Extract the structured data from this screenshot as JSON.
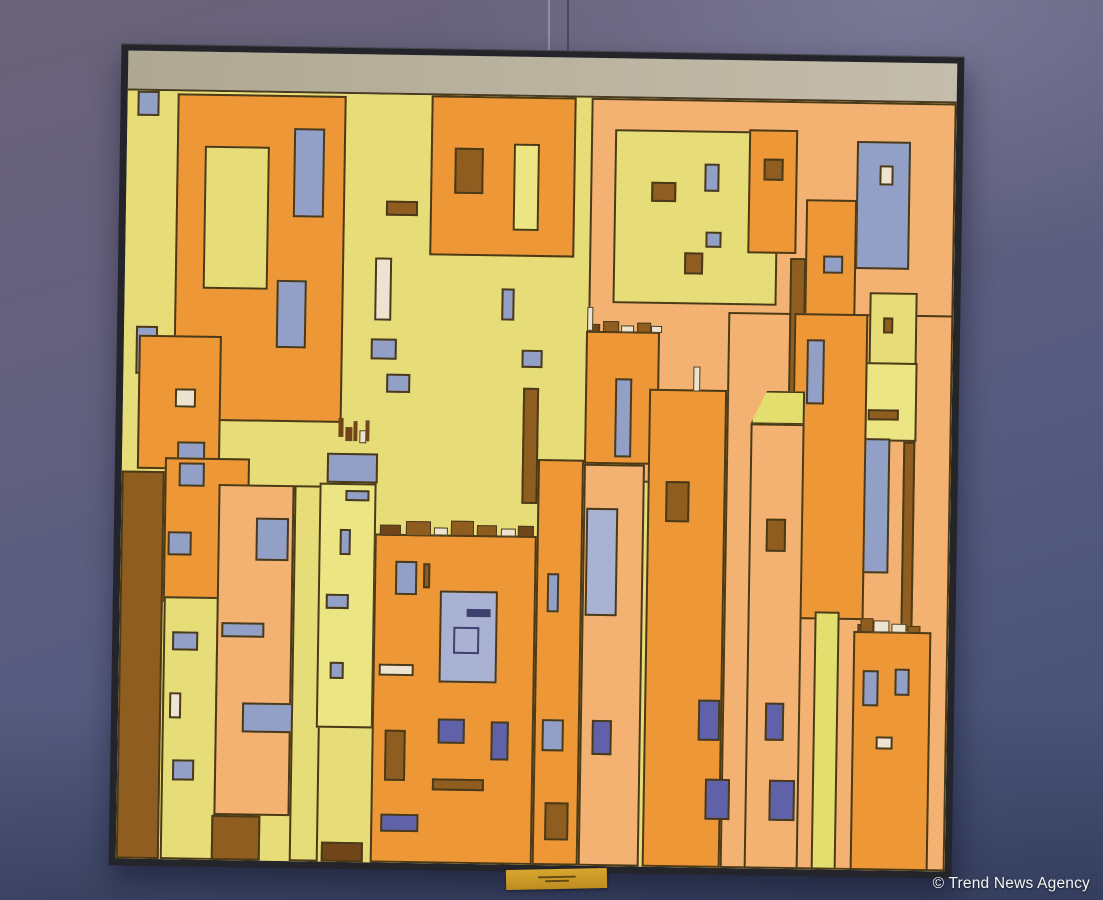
{
  "scene": {
    "watermark": "© Trend News Agency"
  },
  "palette": {
    "yellow": "#e7dd78",
    "paleyellow": "#ece584",
    "stripeyellow": "#e2df6e",
    "orange": "#ee9737",
    "peach": "#f3b271",
    "blue": "#92a0c8",
    "bluelight": "#a9b2d2",
    "dkblue": "#5f62a8",
    "navy": "#3f416e",
    "brown": "#8f5d20",
    "dkbrown": "#70451a",
    "cream": "#ece3d0",
    "outline": "#4b3a18",
    "canvas_strip": "#b7b09c",
    "frame": "#24252b",
    "label": "#c9992a"
  },
  "painting": {
    "rects": [
      {
        "n": "bg-yellow",
        "x": 0,
        "y": 0,
        "w": 100,
        "h": 100,
        "c": "yellow",
        "bw": 0
      },
      {
        "n": "bg-peach-top",
        "x": 56,
        "y": 0,
        "w": 44,
        "h": 50,
        "c": "peach"
      },
      {
        "n": "bg-peach-right",
        "x": 72.8,
        "y": 27.6,
        "w": 27.2,
        "h": 72.4,
        "c": "peach"
      },
      {
        "n": "chip-topleft",
        "x": 1.2,
        "y": 0,
        "w": 2.7,
        "h": 3.2,
        "c": "blue"
      },
      {
        "n": "bldg-a",
        "x": 6,
        "y": 0.3,
        "w": 20.4,
        "h": 42.6,
        "c": "orange"
      },
      {
        "n": "bldg-a-window-yellow",
        "x": 9.4,
        "y": 7,
        "w": 7.8,
        "h": 18.6,
        "c": "yellow"
      },
      {
        "n": "bldg-a-window-blue1",
        "x": 20.1,
        "y": 4.5,
        "w": 3.8,
        "h": 11.7,
        "c": "blue"
      },
      {
        "n": "bldg-a-window-blue2",
        "x": 18.3,
        "y": 24.4,
        "w": 3.7,
        "h": 8.8,
        "c": "blue"
      },
      {
        "n": "chip-left",
        "x": 1.4,
        "y": 30.6,
        "w": 2.7,
        "h": 6.2,
        "c": "blue"
      },
      {
        "n": "bldg-small-left",
        "x": 1.8,
        "y": 31.8,
        "w": 10,
        "h": 17.4,
        "c": "orange"
      },
      {
        "n": "win",
        "x": 6.3,
        "y": 38.7,
        "w": 2.5,
        "h": 2.4,
        "c": "cream"
      },
      {
        "n": "win",
        "x": 6.6,
        "y": 45.6,
        "w": 3.4,
        "h": 3.8,
        "c": "blue"
      },
      {
        "n": "col-brown-left",
        "x": 0,
        "y": 49.5,
        "w": 5.2,
        "h": 50.5,
        "c": "brown"
      },
      {
        "n": "bldg-left-mid",
        "x": 5.2,
        "y": 47.6,
        "w": 10.2,
        "h": 19,
        "c": "orange"
      },
      {
        "n": "win",
        "x": 6.9,
        "y": 48.3,
        "w": 3.1,
        "h": 3.1,
        "c": "blue"
      },
      {
        "n": "win",
        "x": 5.7,
        "y": 57.3,
        "w": 2.9,
        "h": 3.1,
        "c": "blue"
      },
      {
        "n": "bldg-left-yellow",
        "x": 5.3,
        "y": 65.8,
        "w": 6.6,
        "h": 34.2,
        "c": "yellow"
      },
      {
        "n": "win",
        "x": 6.4,
        "y": 70.3,
        "w": 3.1,
        "h": 2.5,
        "c": "blue"
      },
      {
        "n": "win",
        "x": 6.2,
        "y": 78.3,
        "w": 1.4,
        "h": 3.4,
        "c": "cream"
      },
      {
        "n": "win",
        "x": 6.6,
        "y": 87,
        "w": 2.7,
        "h": 2.7,
        "c": "blue"
      },
      {
        "n": "col-peach-left",
        "x": 11.7,
        "y": 51,
        "w": 9.2,
        "h": 43.2,
        "c": "peach"
      },
      {
        "n": "win",
        "x": 16.3,
        "y": 55.3,
        "w": 4,
        "h": 5.6,
        "c": "blue"
      },
      {
        "n": "win",
        "x": 12.3,
        "y": 69,
        "w": 5.2,
        "h": 2,
        "c": "blue"
      },
      {
        "n": "win",
        "x": 15,
        "y": 79.4,
        "w": 6.1,
        "h": 3.9,
        "c": "blue"
      },
      {
        "n": "block-brown",
        "x": 11.5,
        "y": 94.2,
        "w": 5.9,
        "h": 5.8,
        "c": "brown"
      },
      {
        "n": "col-yellow-left",
        "x": 20.9,
        "y": 51,
        "w": 3.5,
        "h": 49,
        "c": "yellow"
      },
      {
        "n": "win",
        "x": 31.4,
        "y": 13.8,
        "w": 3.8,
        "h": 2,
        "c": "brown"
      },
      {
        "n": "win",
        "x": 30.2,
        "y": 21.2,
        "w": 2,
        "h": 8.2,
        "c": "cream"
      },
      {
        "n": "win",
        "x": 29.8,
        "y": 31.8,
        "w": 3.1,
        "h": 2.7,
        "c": "blue"
      },
      {
        "n": "win",
        "x": 31.7,
        "y": 36.3,
        "w": 2.9,
        "h": 2.5,
        "c": "blue"
      },
      {
        "n": "figure",
        "x": 26,
        "y": 42.2,
        "w": 0.6,
        "h": 2.4,
        "c": "dkbrown",
        "bw": 0
      },
      {
        "n": "figure",
        "x": 26.9,
        "y": 43.4,
        "w": 0.9,
        "h": 1.8,
        "c": "dkbrown",
        "bw": 0
      },
      {
        "n": "figure",
        "x": 27.9,
        "y": 42.6,
        "w": 0.5,
        "h": 2.6,
        "c": "dkbrown",
        "bw": 0
      },
      {
        "n": "figure",
        "x": 28.6,
        "y": 43.8,
        "w": 0.8,
        "h": 1.6,
        "c": "cream",
        "bw": 1
      },
      {
        "n": "figure",
        "x": 29.3,
        "y": 42.4,
        "w": 0.5,
        "h": 2.8,
        "c": "dkbrown",
        "bw": 0
      },
      {
        "n": "bar-blue",
        "x": 24.7,
        "y": 46.8,
        "w": 6.2,
        "h": 3.8,
        "c": "blue"
      },
      {
        "n": "tower-pale",
        "x": 23.9,
        "y": 50.6,
        "w": 6.9,
        "h": 31.9,
        "c": "paleyellow"
      },
      {
        "n": "win",
        "x": 27,
        "y": 51.6,
        "w": 2.9,
        "h": 1.4,
        "c": "blue"
      },
      {
        "n": "win",
        "x": 26.4,
        "y": 56.6,
        "w": 1.3,
        "h": 3.4,
        "c": "blue"
      },
      {
        "n": "win",
        "x": 24.9,
        "y": 65.1,
        "w": 2.7,
        "h": 1.9,
        "c": "blue"
      },
      {
        "n": "win",
        "x": 25.4,
        "y": 74,
        "w": 1.8,
        "h": 2.2,
        "c": "blue"
      },
      {
        "n": "block-dkbrown",
        "x": 24.7,
        "y": 97.4,
        "w": 5.1,
        "h": 2.6,
        "c": "dkbrown"
      },
      {
        "n": "bldg-b",
        "x": 36.7,
        "y": 0,
        "w": 17.5,
        "h": 20.8,
        "c": "orange"
      },
      {
        "n": "win",
        "x": 39.6,
        "y": 6.8,
        "w": 3.5,
        "h": 6,
        "c": "brown"
      },
      {
        "n": "win",
        "x": 46.7,
        "y": 6.1,
        "w": 3.1,
        "h": 11.3,
        "c": "paleyellow"
      },
      {
        "n": "win",
        "x": 45.5,
        "y": 25,
        "w": 1.6,
        "h": 4.2,
        "c": "blue"
      },
      {
        "n": "win",
        "x": 48,
        "y": 33,
        "w": 2.6,
        "h": 2.3,
        "c": "blue"
      },
      {
        "n": "bldg-c",
        "x": 58.9,
        "y": 4,
        "w": 19.7,
        "h": 22.7,
        "c": "yellow"
      },
      {
        "n": "win",
        "x": 63.3,
        "y": 10.8,
        "w": 3,
        "h": 2.6,
        "c": "brown"
      },
      {
        "n": "win",
        "x": 69.7,
        "y": 8.3,
        "w": 1.8,
        "h": 3.7,
        "c": "blue"
      },
      {
        "n": "win",
        "x": 70,
        "y": 17.2,
        "w": 1.9,
        "h": 2.1,
        "c": "blue"
      },
      {
        "n": "win",
        "x": 67.4,
        "y": 19.9,
        "w": 2.3,
        "h": 2.9,
        "c": "brown"
      },
      {
        "n": "bldg-d",
        "x": 75,
        "y": 3.8,
        "w": 5.9,
        "h": 16.1,
        "c": "orange"
      },
      {
        "n": "win",
        "x": 76.8,
        "y": 7.5,
        "w": 2.5,
        "h": 2.9,
        "c": "brown"
      },
      {
        "n": "bldg-blue-tall",
        "x": 88.1,
        "y": 5.1,
        "w": 6.5,
        "h": 16.7,
        "c": "blue"
      },
      {
        "n": "win",
        "x": 90.8,
        "y": 8.2,
        "w": 1.7,
        "h": 2.6,
        "c": "cream"
      },
      {
        "n": "col-orange-tr",
        "x": 82,
        "y": 12.8,
        "w": 6.2,
        "h": 17.8,
        "c": "orange"
      },
      {
        "n": "win",
        "x": 84.2,
        "y": 20.1,
        "w": 2.4,
        "h": 2.3,
        "c": "blue"
      },
      {
        "n": "stripe-brown-tr",
        "x": 80.2,
        "y": 20.4,
        "w": 2,
        "h": 18.4,
        "c": "brown"
      },
      {
        "n": "bldg-yellow-tr1",
        "x": 89.9,
        "y": 24.7,
        "w": 5.8,
        "h": 14.7,
        "c": "yellow"
      },
      {
        "n": "win",
        "x": 91.5,
        "y": 28,
        "w": 1.3,
        "h": 2.1,
        "c": "brown"
      },
      {
        "n": "bldg-yellow-tr2",
        "x": 88.1,
        "y": 33.8,
        "w": 7.7,
        "h": 10.4,
        "c": "paleyellow"
      },
      {
        "n": "win",
        "x": 89.9,
        "y": 40,
        "w": 3.7,
        "h": 1.4,
        "c": "brown"
      },
      {
        "n": "pole-brown",
        "x": 94.2,
        "y": 44.2,
        "w": 1.4,
        "h": 24.6,
        "c": "brown"
      },
      {
        "n": "window-blue-long",
        "x": 89.3,
        "y": 43.8,
        "w": 3.4,
        "h": 17.5,
        "c": "blue"
      },
      {
        "n": "col-orange-e",
        "x": 80.8,
        "y": 27.6,
        "w": 8.9,
        "h": 39.8,
        "c": "orange"
      },
      {
        "n": "win",
        "x": 82.4,
        "y": 31,
        "w": 2.2,
        "h": 8.5,
        "c": "blue"
      },
      {
        "n": "bldg-f",
        "x": 55.7,
        "y": 30.4,
        "w": 9,
        "h": 17.2,
        "c": "orange"
      },
      {
        "n": "win",
        "x": 59.3,
        "y": 36.5,
        "w": 2.1,
        "h": 10.2,
        "c": "blue"
      },
      {
        "n": "col-orange-2",
        "x": 63.5,
        "y": 37.8,
        "w": 9.3,
        "h": 62.2,
        "c": "orange"
      },
      {
        "n": "pole-cream",
        "x": 68.7,
        "y": 34.8,
        "w": 0.9,
        "h": 3.2,
        "c": "cream",
        "bw": 1
      },
      {
        "n": "win",
        "x": 65.6,
        "y": 49.7,
        "w": 2.9,
        "h": 5.4,
        "c": "brown"
      },
      {
        "n": "win",
        "x": 70,
        "y": 78.1,
        "w": 2.6,
        "h": 5.3,
        "c": "dkblue"
      },
      {
        "n": "win",
        "x": 70.9,
        "y": 88.4,
        "w": 3,
        "h": 5.3,
        "c": "dkblue"
      },
      {
        "n": "stripe-brown-mid",
        "x": 48.2,
        "y": 37.9,
        "w": 2,
        "h": 15.1,
        "c": "brown"
      },
      {
        "n": "wedge-yellow",
        "x": 75.7,
        "y": 37.8,
        "w": 6.6,
        "h": 4.4,
        "c": "stripeyellow",
        "clip": 1
      },
      {
        "n": "col-peach-wedge",
        "x": 75.7,
        "y": 42,
        "w": 6.6,
        "h": 58,
        "c": "peach"
      },
      {
        "n": "win",
        "x": 77.8,
        "y": 54.4,
        "w": 2.4,
        "h": 4.3,
        "c": "brown"
      },
      {
        "n": "win",
        "x": 78,
        "y": 78.4,
        "w": 2.3,
        "h": 4.9,
        "c": "dkblue"
      },
      {
        "n": "win",
        "x": 78.6,
        "y": 88.4,
        "w": 3.2,
        "h": 5.3,
        "c": "dkblue"
      },
      {
        "n": "bldg-g",
        "x": 30.6,
        "y": 57.2,
        "w": 19.6,
        "h": 42.8,
        "c": "orange"
      },
      {
        "n": "win",
        "x": 33.2,
        "y": 60.7,
        "w": 2.6,
        "h": 4.4,
        "c": "blue"
      },
      {
        "n": "win",
        "x": 36.6,
        "y": 61,
        "w": 0.8,
        "h": 3.2,
        "c": "brown"
      },
      {
        "n": "window-big-blue",
        "x": 38.6,
        "y": 64.5,
        "w": 7,
        "h": 11.9,
        "c": "bluelight"
      },
      {
        "n": "bar-navy",
        "x": 41.9,
        "y": 66.8,
        "w": 2.8,
        "h": 1.1,
        "c": "navy",
        "bw": 0
      },
      {
        "n": "square-inner",
        "x": 40.3,
        "y": 69.1,
        "w": 3.1,
        "h": 3.6,
        "c": "bluelight",
        "bc": "navy"
      },
      {
        "n": "win",
        "x": 31.4,
        "y": 74.1,
        "w": 4.2,
        "h": 1.5,
        "c": "cream"
      },
      {
        "n": "win",
        "x": 32.2,
        "y": 82.7,
        "w": 2.5,
        "h": 6.6,
        "c": "brown"
      },
      {
        "n": "win",
        "x": 38.6,
        "y": 81.1,
        "w": 3.3,
        "h": 3.3,
        "c": "dkblue"
      },
      {
        "n": "win",
        "x": 45,
        "y": 81.4,
        "w": 2.2,
        "h": 5,
        "c": "dkblue"
      },
      {
        "n": "win",
        "x": 38,
        "y": 88.9,
        "w": 6.3,
        "h": 1.6,
        "c": "brown"
      },
      {
        "n": "win",
        "x": 31.8,
        "y": 93.6,
        "w": 4.6,
        "h": 2.4,
        "c": "dkblue"
      },
      {
        "n": "col-orange-h",
        "x": 50.2,
        "y": 47.2,
        "w": 5.5,
        "h": 52.8,
        "c": "orange"
      },
      {
        "n": "win",
        "x": 51.5,
        "y": 62,
        "w": 1.5,
        "h": 5,
        "c": "blue"
      },
      {
        "n": "win",
        "x": 51.2,
        "y": 81,
        "w": 2.6,
        "h": 4.2,
        "c": "blue"
      },
      {
        "n": "win",
        "x": 51.6,
        "y": 91.8,
        "w": 2.9,
        "h": 5,
        "c": "brown"
      },
      {
        "n": "col-peach-mid",
        "x": 55.7,
        "y": 47.6,
        "w": 7.4,
        "h": 52.4,
        "c": "peach"
      },
      {
        "n": "window-big-blue2",
        "x": 56.1,
        "y": 53.4,
        "w": 3.9,
        "h": 14.1,
        "c": "bluelight"
      },
      {
        "n": "win",
        "x": 57.2,
        "y": 81,
        "w": 2.4,
        "h": 4.6,
        "c": "dkblue"
      },
      {
        "n": "stripe-yellow",
        "x": 83.8,
        "y": 66.4,
        "w": 3.1,
        "h": 33.6,
        "c": "stripeyellow"
      },
      {
        "n": "bldg-br-corner",
        "x": 88.6,
        "y": 68.9,
        "w": 9.4,
        "h": 31.1,
        "c": "orange"
      },
      {
        "n": "win",
        "x": 89.7,
        "y": 73.9,
        "w": 2,
        "h": 4.7,
        "c": "blue"
      },
      {
        "n": "win",
        "x": 93.6,
        "y": 73.7,
        "w": 1.8,
        "h": 3.5,
        "c": "blue"
      },
      {
        "n": "win",
        "x": 91.4,
        "y": 82.6,
        "w": 2.1,
        "h": 1.6,
        "c": "cream"
      },
      {
        "n": "rubble",
        "x": 31.2,
        "y": 56,
        "w": 2.6,
        "h": 1.4,
        "c": "dkbrown",
        "bw": 1
      },
      {
        "n": "rubble",
        "x": 34.4,
        "y": 55.5,
        "w": 3,
        "h": 1.9,
        "c": "brown",
        "bw": 1
      },
      {
        "n": "rubble",
        "x": 37.8,
        "y": 56.2,
        "w": 1.6,
        "h": 1.1,
        "c": "cream",
        "bw": 1
      },
      {
        "n": "rubble",
        "x": 39.8,
        "y": 55.3,
        "w": 2.8,
        "h": 2,
        "c": "brown",
        "bw": 1
      },
      {
        "n": "rubble",
        "x": 43,
        "y": 55.8,
        "w": 2.4,
        "h": 1.5,
        "c": "brown",
        "bw": 1
      },
      {
        "n": "rubble",
        "x": 45.8,
        "y": 56.3,
        "w": 1.8,
        "h": 1,
        "c": "cream",
        "bw": 1
      },
      {
        "n": "rubble",
        "x": 47.9,
        "y": 55.9,
        "w": 1.9,
        "h": 1.4,
        "c": "dkbrown",
        "bw": 1
      },
      {
        "n": "rubble",
        "x": 55.9,
        "y": 29.4,
        "w": 1.5,
        "h": 1.1,
        "c": "dkbrown",
        "bw": 1
      },
      {
        "n": "rubble",
        "x": 57.8,
        "y": 29,
        "w": 1.9,
        "h": 1.5,
        "c": "brown",
        "bw": 1
      },
      {
        "n": "rubble",
        "x": 60,
        "y": 29.5,
        "w": 1.5,
        "h": 1,
        "c": "cream",
        "bw": 1
      },
      {
        "n": "rubble",
        "x": 61.9,
        "y": 29.2,
        "w": 1.7,
        "h": 1.3,
        "c": "brown",
        "bw": 1
      },
      {
        "n": "rubble",
        "x": 63.6,
        "y": 29.6,
        "w": 1.3,
        "h": 0.9,
        "c": "cream",
        "bw": 1
      },
      {
        "n": "pole-cream-f",
        "x": 55.8,
        "y": 27.2,
        "w": 0.8,
        "h": 3.2,
        "c": "cream",
        "bw": 1
      },
      {
        "n": "rubble",
        "x": 89,
        "y": 68,
        "w": 1.7,
        "h": 1,
        "c": "dkbrown",
        "bw": 1
      },
      {
        "n": "rubble",
        "x": 90.9,
        "y": 67.5,
        "w": 2,
        "h": 1.5,
        "c": "cream",
        "bw": 1
      },
      {
        "n": "rubble",
        "x": 93.1,
        "y": 67.9,
        "w": 1.8,
        "h": 1.1,
        "c": "cream",
        "bw": 1
      },
      {
        "n": "rubble",
        "x": 95.1,
        "y": 68.1,
        "w": 1.5,
        "h": 0.9,
        "c": "brown",
        "bw": 1
      },
      {
        "n": "rubble",
        "x": 89.4,
        "y": 67.2,
        "w": 1.6,
        "h": 1.8,
        "c": "brown",
        "bw": 1
      }
    ]
  }
}
